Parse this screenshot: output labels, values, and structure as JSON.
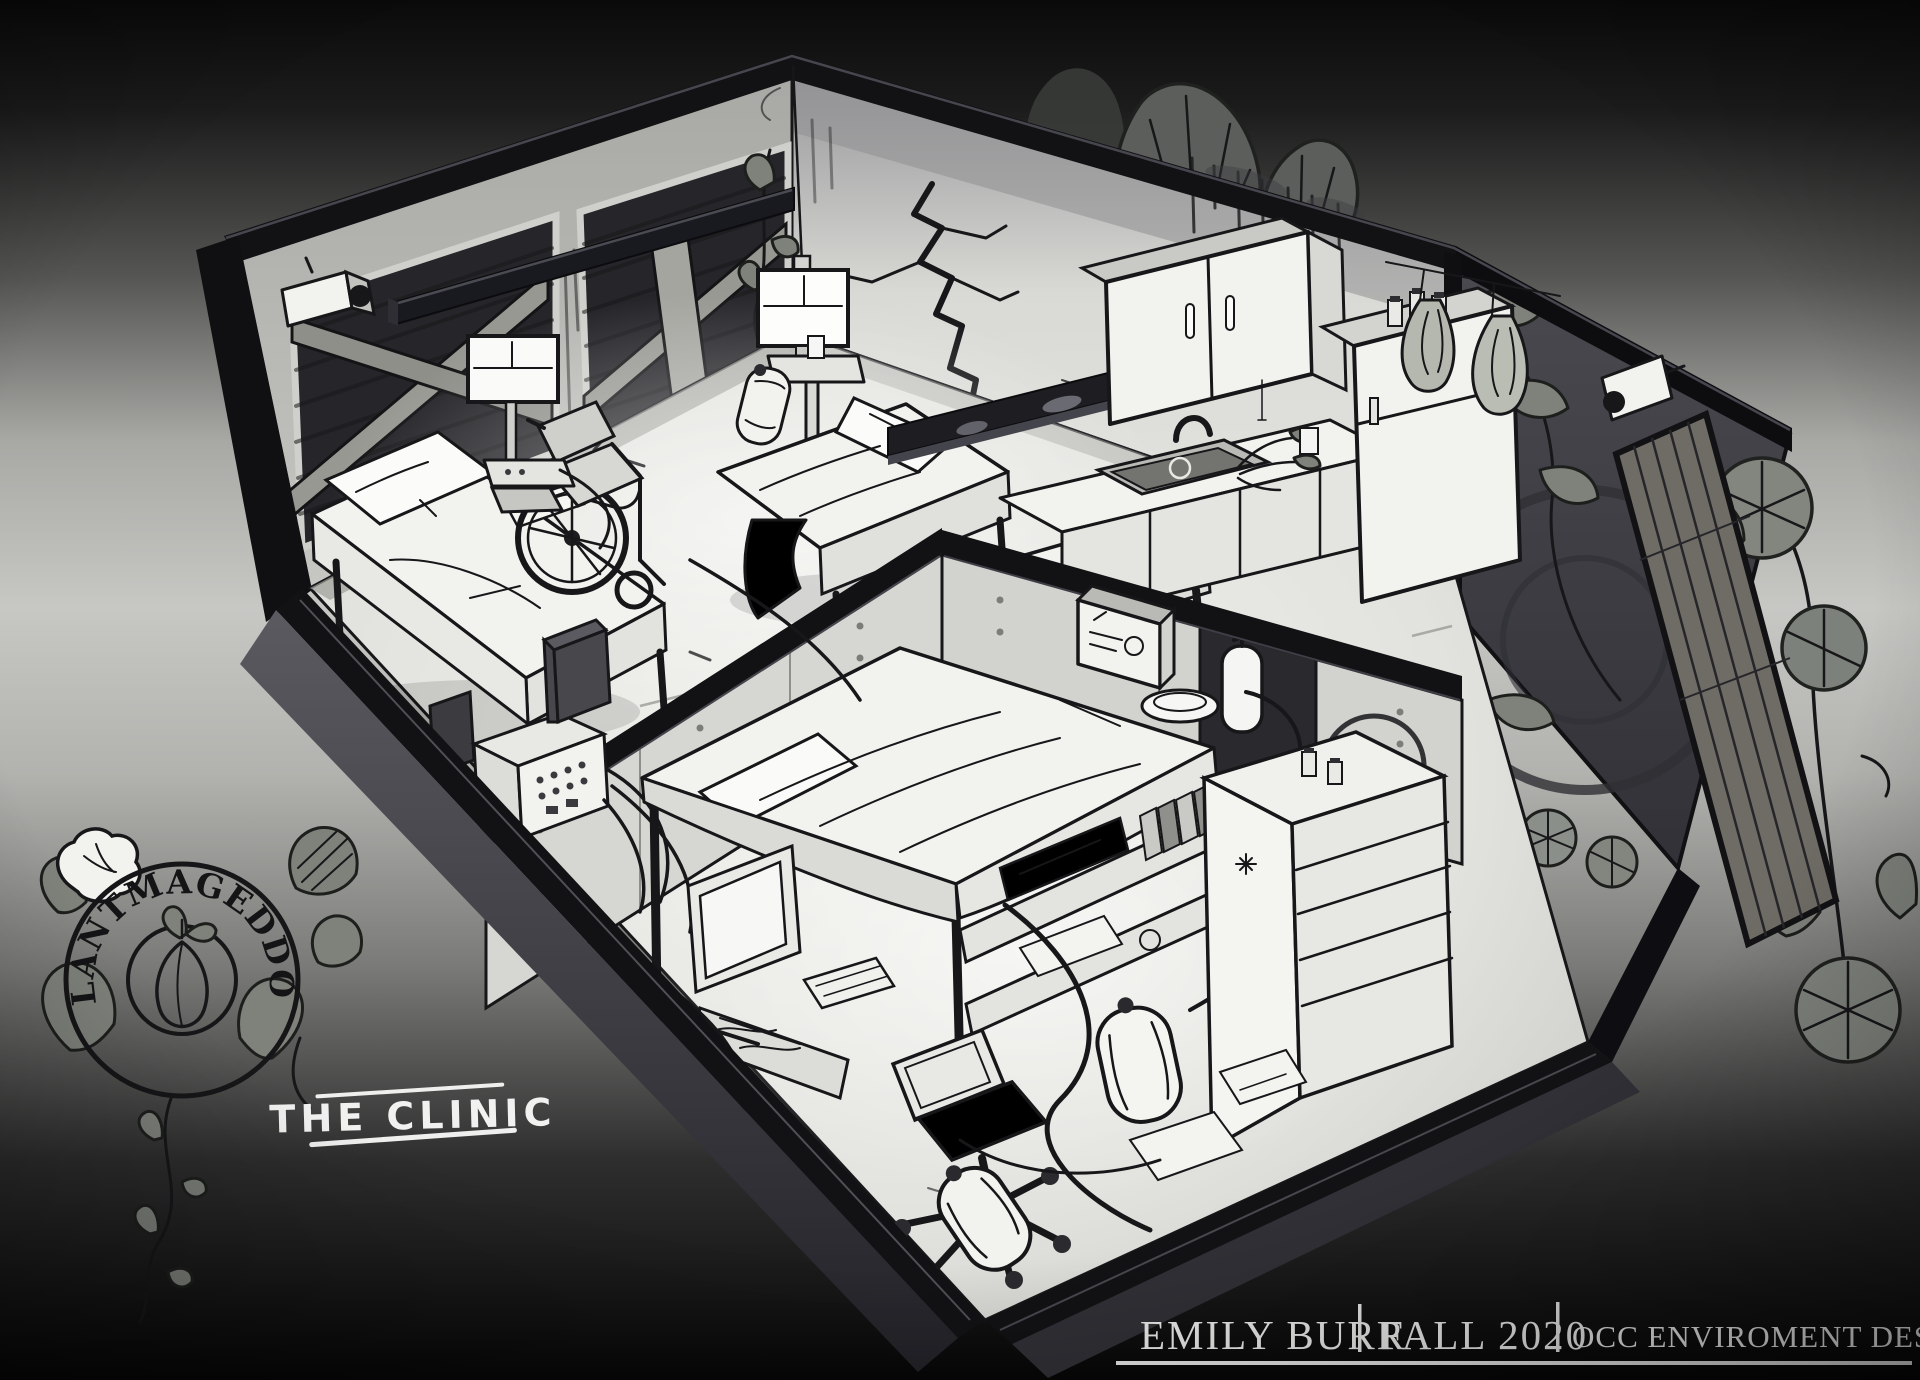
{
  "logo": {
    "title": "PLANTMAGEDDON"
  },
  "scene_label": {
    "title": "THE CLINIC"
  },
  "credits": {
    "artist": "EMILY BURR",
    "term": "FALL 2020",
    "course": "OCC ENVIROMENT DESIGN"
  },
  "colors": {
    "ink": "#17171a",
    "wall_dark": "#121215",
    "accent_wall": "#46464b",
    "floor_light": "#efefeb",
    "background_top": "#0a0a0a",
    "background_mid": "#c7c7c4",
    "background_bottom": "#070707",
    "foliage": "#7e827b",
    "label_text": "#f1f1ef"
  },
  "scene": {
    "rooms": [
      "patient-ward",
      "operating-room"
    ],
    "objects": [
      "boarded-window",
      "security-camera",
      "hospital-bed",
      "pillow",
      "wheelchair",
      "patient-monitor",
      "monitor-cart",
      "suspended-light-bar",
      "hanging-monitor",
      "sink-counter",
      "faucet",
      "upper-cabinet",
      "refrigerator",
      "dried-herbs",
      "wall-crack",
      "first-aid-box",
      "fire-extinguisher",
      "operating-table",
      "shelf-unit",
      "crt-monitor",
      "keyboard",
      "office-chair",
      "oxygen-tank",
      "dresser",
      "pill-bottles",
      "control-box",
      "cables",
      "wooden-door",
      "morning-glory-flowers",
      "vines",
      "logo-seedling"
    ]
  }
}
